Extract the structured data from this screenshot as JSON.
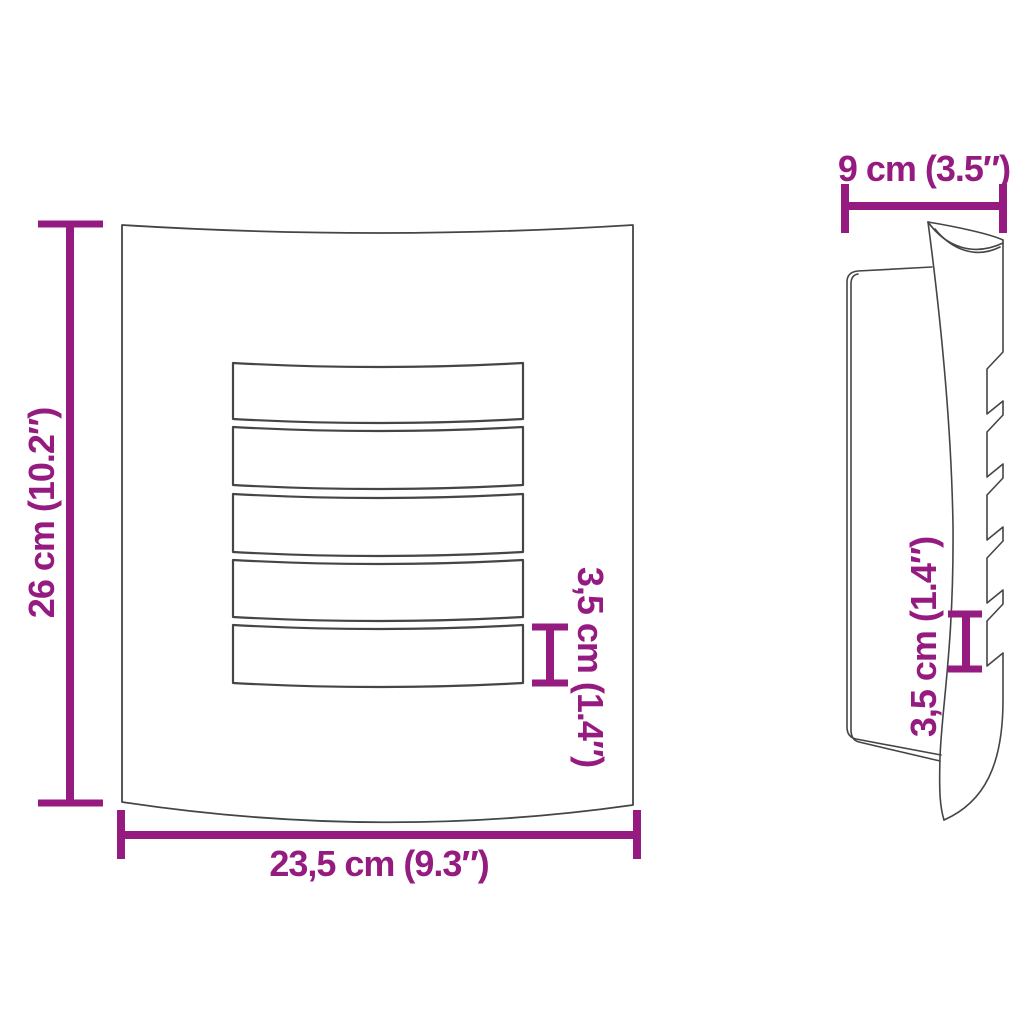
{
  "colors": {
    "accent": "#951B81",
    "line": "#454545",
    "background": "#FFFFFF"
  },
  "front_view": {
    "height_label": "26 cm (10.2″)",
    "width_label": "23,5 cm (9.3″)",
    "slat_height_label": "3,5 cm (1.4″)",
    "slat_count": 5
  },
  "side_view": {
    "depth_label": "9 cm (3.5″)",
    "slat_height_label": "3,5 cm (1.4″)",
    "louver_count": 5
  }
}
